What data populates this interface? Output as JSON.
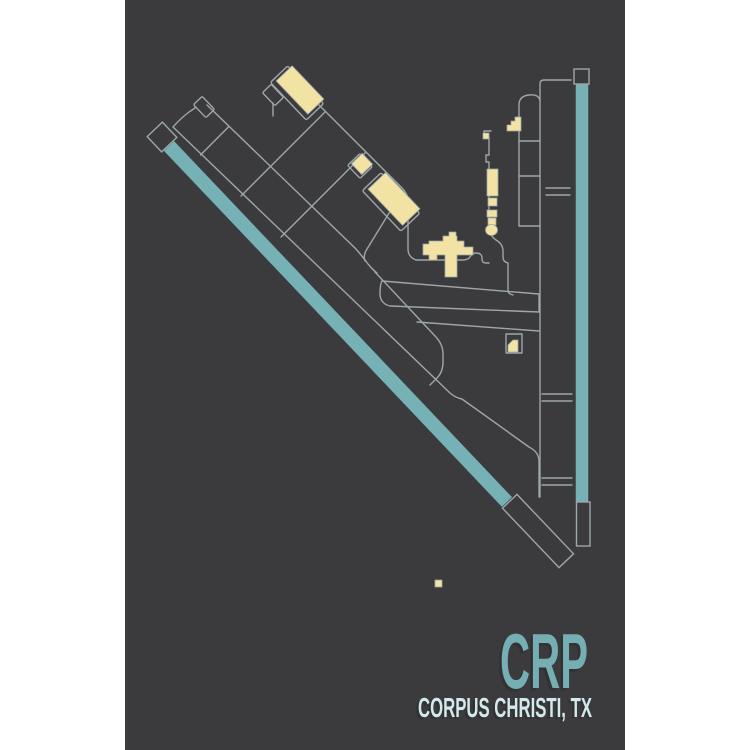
{
  "poster": {
    "airport_code": "CRP",
    "city_label": "CORPUS CHRISTI, TX",
    "colors": {
      "canvas_white": "#FFFFFF",
      "poster_background": "#3B3B3D",
      "taxiway_line": "#9EA7A8",
      "runway_teal": "#76B1B5",
      "building_cream": "#F2E3A4",
      "title_teal": "#75AEB3",
      "subtitle_pale": "#D3E9EB",
      "text_shadow": "#2B2C2E"
    },
    "icons": [
      "diagonal-runway-icon",
      "vertical-runway-icon",
      "taxiway-network-icon",
      "terminal-building-icon",
      "hangar-building-icon"
    ]
  }
}
